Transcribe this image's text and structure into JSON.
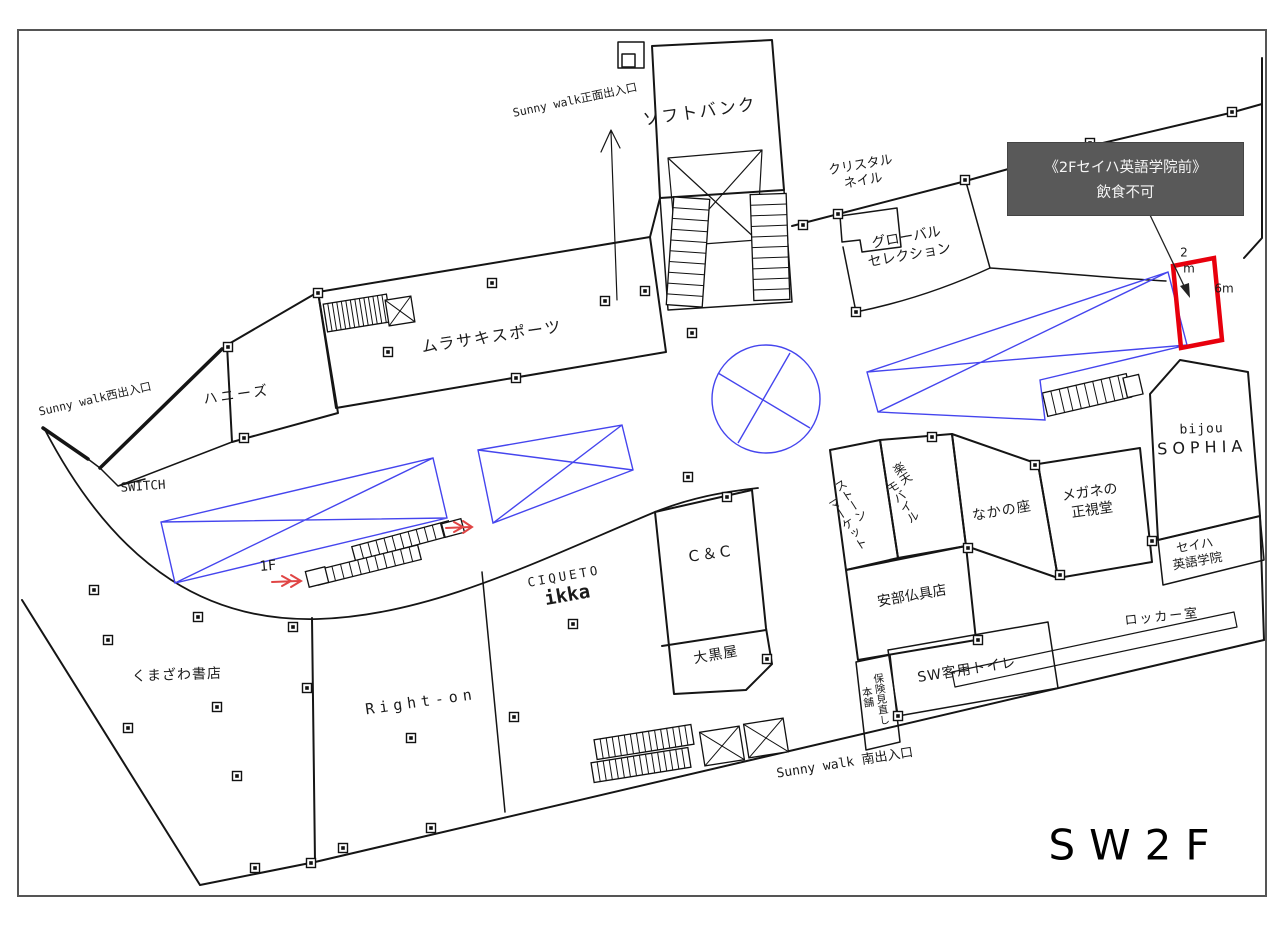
{
  "page": {
    "floor_title": "SW2F"
  },
  "notice": {
    "line1": "《2Fセイハ英語学院前》",
    "line2": "飲食不可",
    "bg": "#595959",
    "fg": "#f5f5f5"
  },
  "highlight": {
    "width_digit": "2",
    "width_unit": "m",
    "height_label": "6m",
    "color": "#e8000d"
  },
  "overlay_color": "#4545ee",
  "arrow_color": "#e04545",
  "entrances": {
    "main": "Sunny walk正面出入口",
    "west": "Sunny walk西出入口",
    "south": "Sunny walk 南出入口"
  },
  "links": {
    "floor_1f": "1F"
  },
  "stores": {
    "softbank": "ソフトバンク",
    "crystal_nail_1": "クリスタル",
    "crystal_nail_2": "ネイル",
    "global_selection_1": "グローバル",
    "global_selection_2": "セレクション",
    "murasaki_sports": "ムラサキスポーツ",
    "honeys": "ハニーズ",
    "switch": "SWITCH",
    "bijou_1": "bijou",
    "bijou_2": "SOPHIA",
    "megane_1": "メガネの",
    "megane_2": "正視堂",
    "nakanoza": "なかの座",
    "stone_market_1": "ストーン",
    "stone_market_2": "マーケット",
    "rakuten_1": "楽天",
    "rakuten_2": "モバイル",
    "seiha_1": "セイハ",
    "seiha_2": "英語学院",
    "locker_room": "ロッカー室",
    "abe_butsugu": "安部仏具店",
    "sw_toilet": "SW客用トイレ",
    "hoken_1": "保険見直し",
    "hoken_2": "本舗",
    "daikokuya": "大黒屋",
    "cc": "C＆C",
    "ciqueto_1": "CIQUETO",
    "ciqueto_2": "ikka",
    "right_on": "Right-on",
    "kumazawa": "くまざわ書店"
  }
}
